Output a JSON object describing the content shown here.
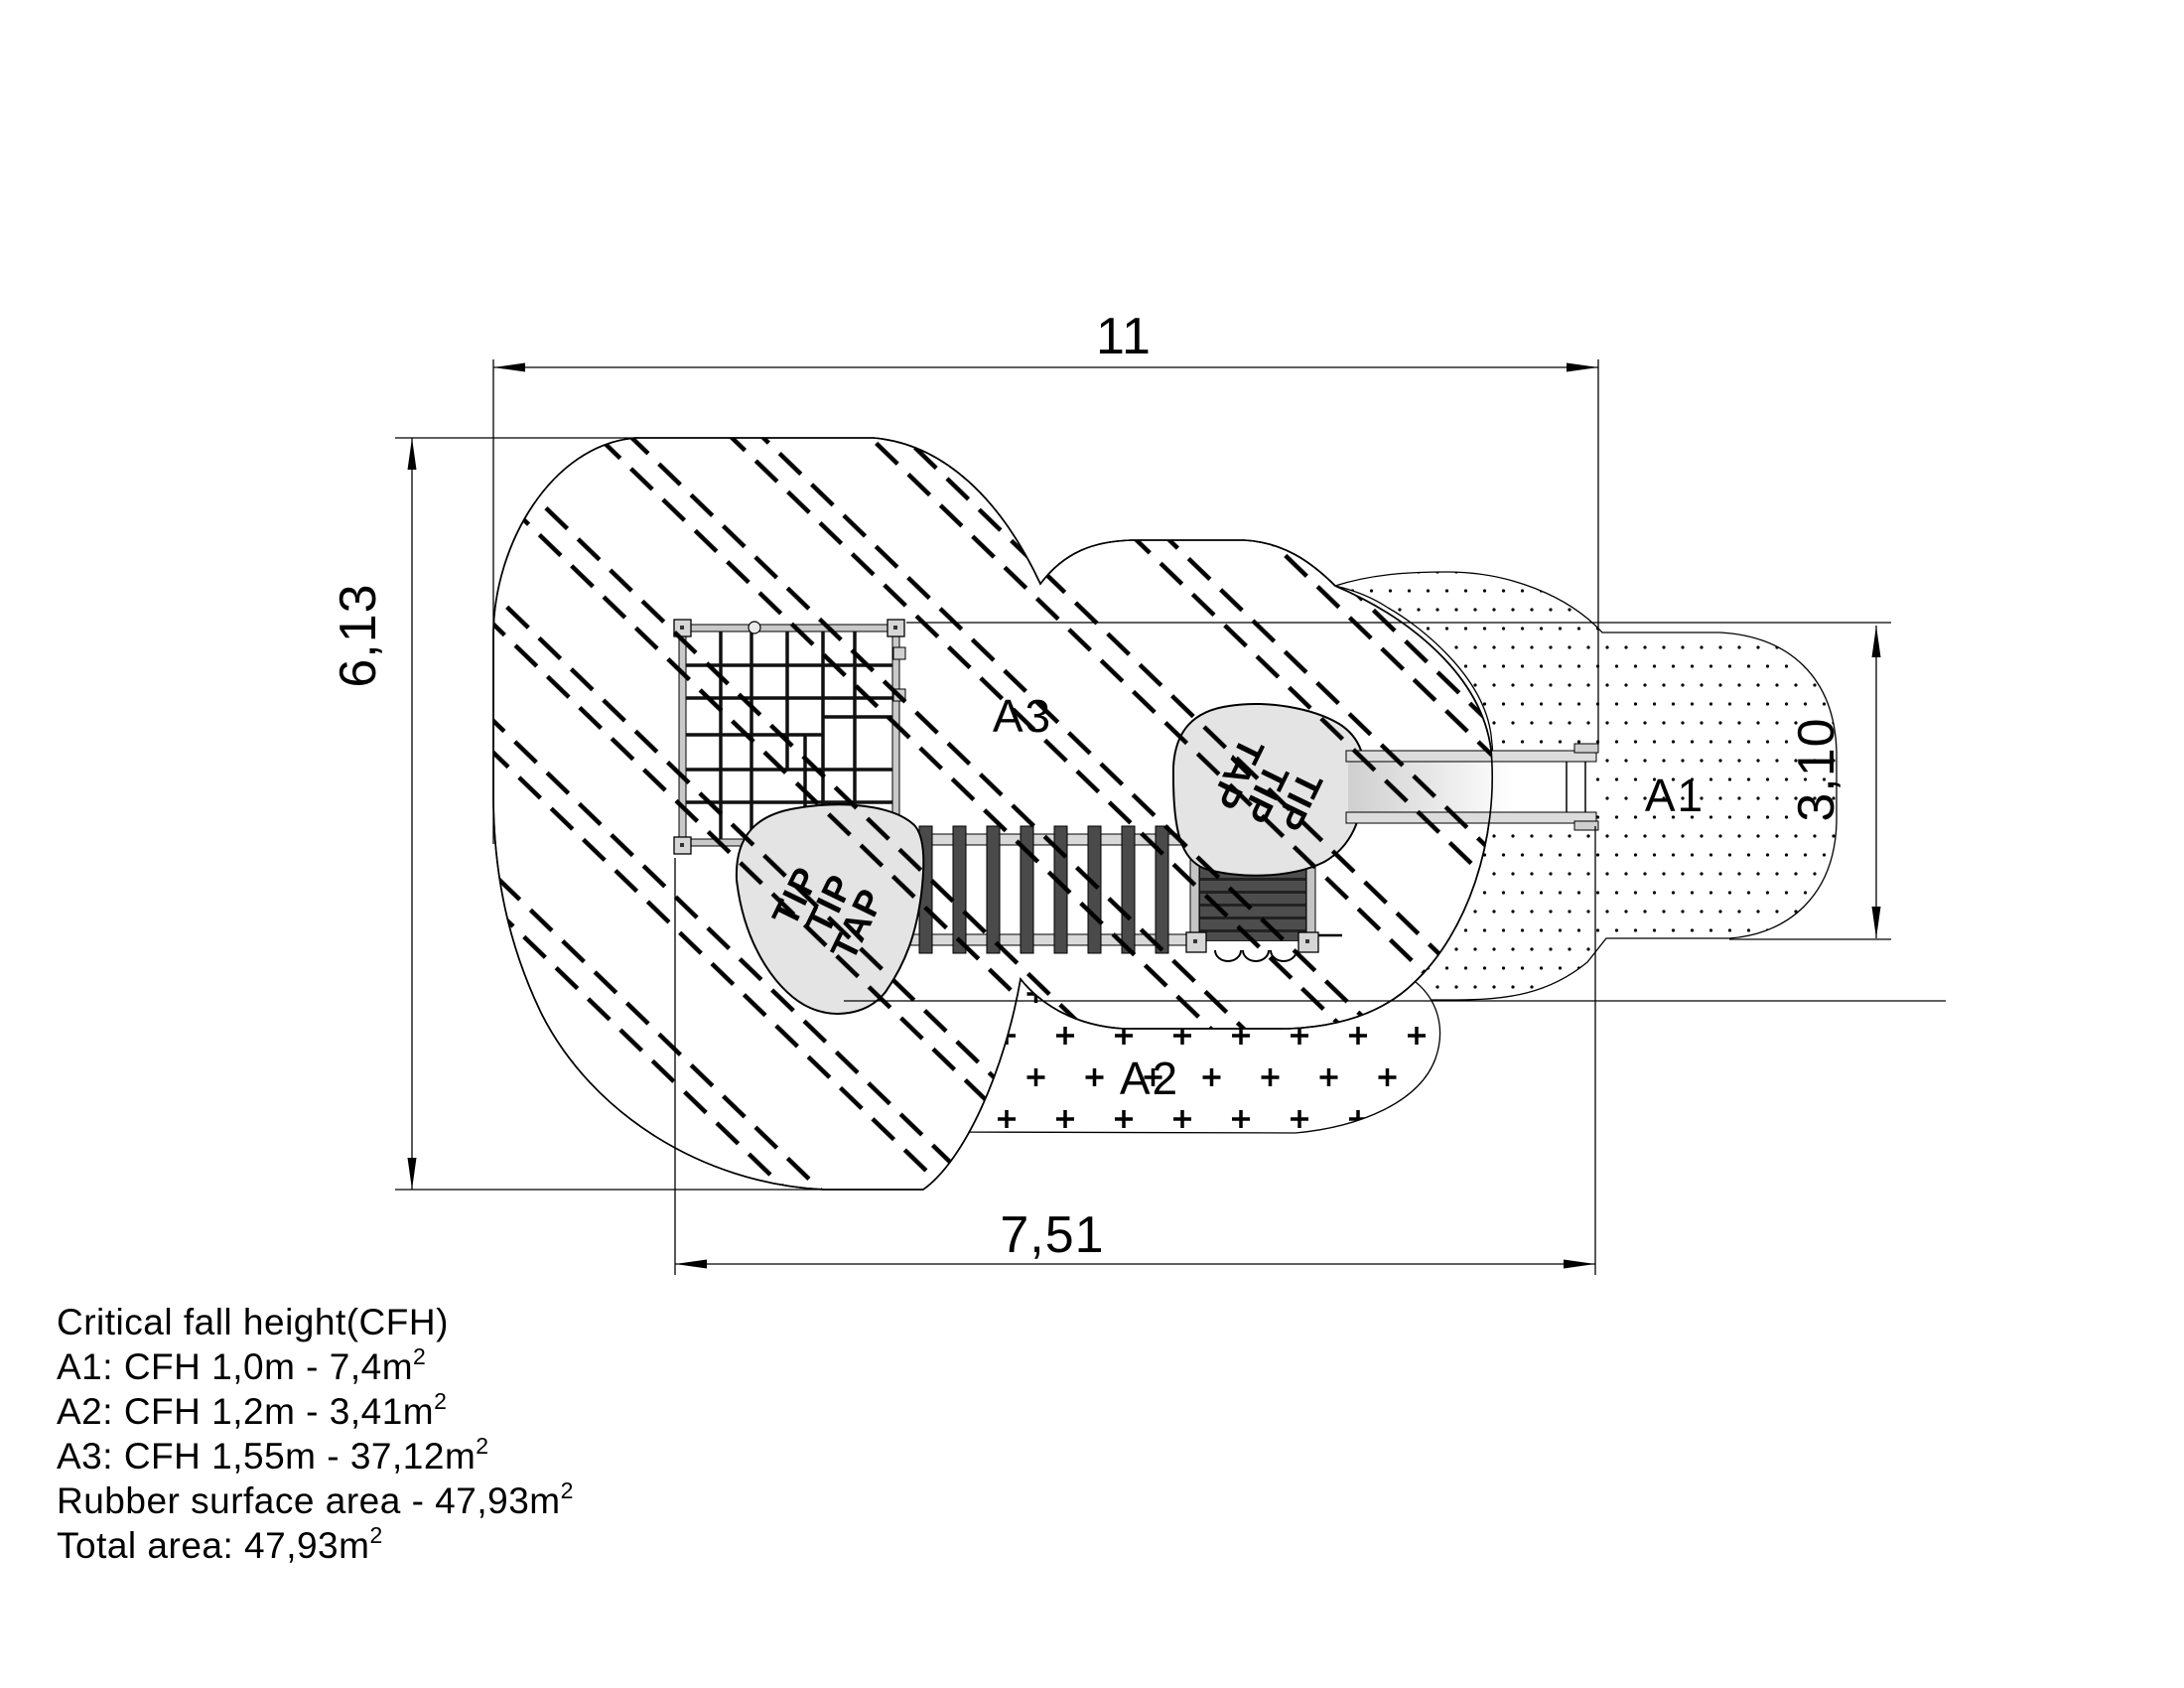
{
  "dimensions": {
    "top": "11",
    "bottom": "7,51",
    "left": "6,13",
    "right": "3,10"
  },
  "area_labels": {
    "a1": "A1",
    "a2": "A2",
    "a3": "A3"
  },
  "tip_tap_logo": {
    "lines": [
      "TIP",
      "TIP",
      "TAP"
    ]
  },
  "cfh_notes": {
    "title": "Critical fall height(CFH)",
    "lines": [
      {
        "text": "A1: CFH 1,0m - 7,4m",
        "sup": "2"
      },
      {
        "text": "A2: CFH 1,2m - 3,41m",
        "sup": "2"
      },
      {
        "text": "A3: CFH 1,55m - 37,12m",
        "sup": "2"
      },
      {
        "text": "Rubber surface area - 47,93m",
        "sup": "2"
      },
      {
        "text": "Total area: 47,93m",
        "sup": "2"
      }
    ]
  },
  "colors": {
    "line": "#000000",
    "background": "#ffffff",
    "blob_fill": "#e4e4e4",
    "equipment_gray": "#d6d6d6",
    "rail_gray": "#d9d9d9",
    "rung_dark": "#4a4a4a",
    "slat_dark": "#4d4d4d"
  }
}
